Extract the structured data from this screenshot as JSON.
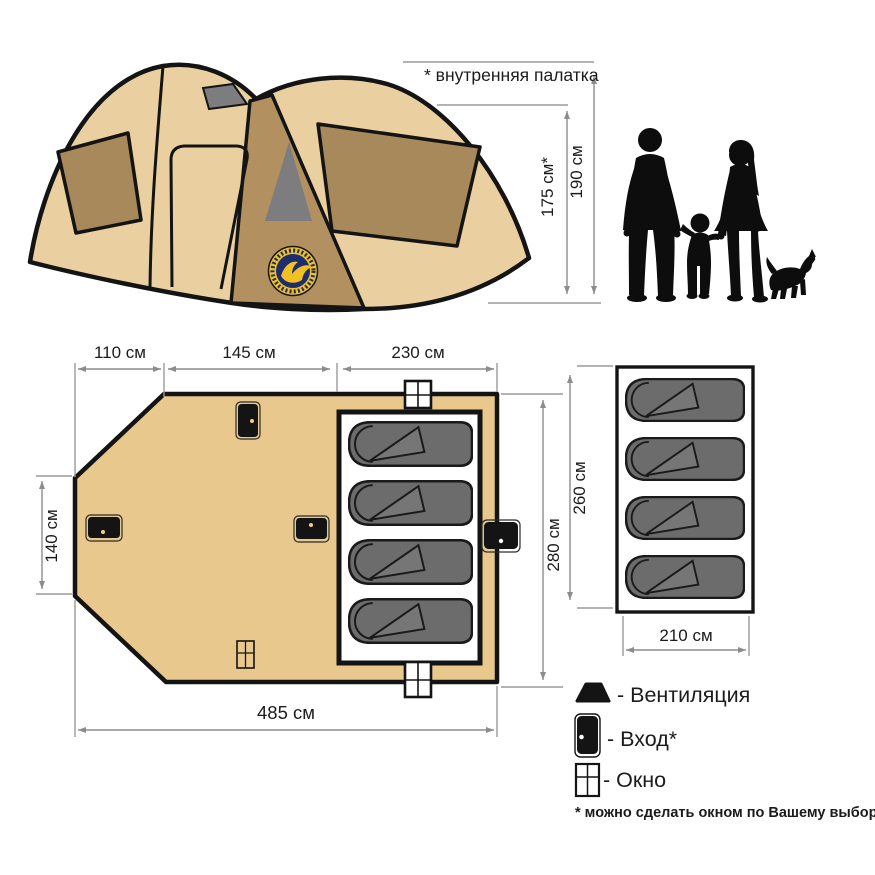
{
  "annotations": {
    "inner_tent_note": "* внутренняя палатка",
    "footnote": "* можно сделать окном по Вашему выбору"
  },
  "dimensions": {
    "tent_inner_height": "175 см*",
    "tent_outer_height": "190 см",
    "plan_top_left": "110 см",
    "plan_top_mid": "145 см",
    "plan_top_right": "230 см",
    "plan_left": "140 см",
    "plan_right": "280 см",
    "plan_bottom": "485 см",
    "inner_tent_height": "260 см",
    "inner_tent_width": "210 см"
  },
  "legend": {
    "vent": "- Вентиляция",
    "entrance": "- Вход*",
    "window": "- Окно"
  },
  "colors": {
    "tent_body": "#ead0a0",
    "tent_window": "#a8895c",
    "tent_front_panel": "#b3905f",
    "vent_gray": "#7d7d80",
    "floor": "#e9c88d",
    "bag_gray": "#6c6c6c",
    "bag_flap": "#767676",
    "logo_navy": "#1e2d6e",
    "logo_yellow": "#f0c024",
    "door_dot": "#f0d080",
    "silhouette_black": "#0d0d0d"
  }
}
